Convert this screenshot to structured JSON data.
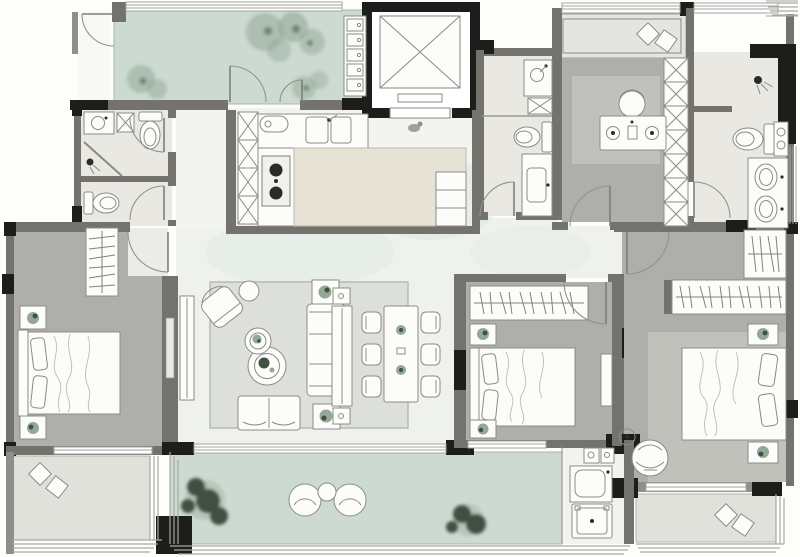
{
  "colors": {
    "bg": "#fdfdfc",
    "wall_dark": "#1d1d1c",
    "wall_gray": "#73726d",
    "wall_mid": "#8f8e88",
    "furn": "#fcfcfa",
    "fstroke": "#8b8b85",
    "balcony": "#ccdad2",
    "bedroom": "#aeaeaa",
    "living": "#eff1ec",
    "bath": "#e9e8e3",
    "graybalc": "#e1e1dc",
    "island": "#e6e2d5",
    "rug": "#dcdfda",
    "rugdark": "#c6c6c1",
    "tree_light": "#93a896",
    "tree_dark": "#41503f",
    "teal": "#d9e7e2"
  },
  "plan": {
    "type": "residential-apartment-floor-plan",
    "rooms": [
      {
        "id": "entry-garden-balcony",
        "fixtures": [
          "trees",
          "entry-door",
          "double-french-doors",
          "window-band",
          "folding-window-column"
        ]
      },
      {
        "id": "elevator",
        "fixtures": [
          "elevator-shaft-x",
          "elevator-door"
        ]
      },
      {
        "id": "kitchen",
        "fixtures": [
          "double-sink",
          "cooktop",
          "island-counter",
          "pantry-column",
          "side-cabinet"
        ]
      },
      {
        "id": "guest-bathroom",
        "fixtures": [
          "vanity-sink",
          "toilet",
          "shower-screen",
          "washer-box"
        ]
      },
      {
        "id": "second-wc",
        "fixtures": [
          "toilet"
        ]
      },
      {
        "id": "left-bedroom",
        "fixtures": [
          "double-bed",
          "wardrobe-hangers",
          "nightstand-plant",
          "nightstand-plant"
        ]
      },
      {
        "id": "left-balcony",
        "fixtures": [
          "floor-cushions",
          "railing"
        ]
      },
      {
        "id": "living-room",
        "fixtures": [
          "sofa",
          "armchair",
          "ottoman",
          "nesting-coffee-tables",
          "tv-console",
          "bench",
          "side-table-plant",
          "side-table-plant",
          "rug"
        ]
      },
      {
        "id": "dining-area",
        "fixtures": [
          "dining-table",
          "six-chairs",
          "sideboard"
        ]
      },
      {
        "id": "middle-bathroom",
        "fixtures": [
          "shower-zone",
          "vanity-sink",
          "toilet",
          "wash-counter"
        ]
      },
      {
        "id": "study-bedroom",
        "fixtures": [
          "desk",
          "desk-chair",
          "wardrobe-column",
          "window-seat",
          "cushions",
          "rug"
        ]
      },
      {
        "id": "master-bathroom",
        "fixtures": [
          "shower-head",
          "toilet",
          "double-vanity",
          "towel-niche"
        ]
      },
      {
        "id": "master-bedroom",
        "fixtures": [
          "double-bed",
          "wardrobe-hangers",
          "wardrobe-hangers",
          "nightstand-plant",
          "nightstand-plant",
          "lounge-chair",
          "floor-lamp",
          "rug"
        ]
      },
      {
        "id": "master-balcony",
        "fixtures": [
          "floor-cushions",
          "railing"
        ]
      },
      {
        "id": "middle-bedroom",
        "fixtures": [
          "double-bed",
          "wardrobe-hangers",
          "nightstand-plant",
          "nightstand-plant",
          "dresser"
        ]
      },
      {
        "id": "south-balcony",
        "fixtures": [
          "trees",
          "lounge-chairs",
          "round-table",
          "railing"
        ]
      },
      {
        "id": "laundry-nook",
        "fixtures": [
          "washing-machine",
          "utility-sink",
          "storage-boxes"
        ]
      }
    ]
  }
}
